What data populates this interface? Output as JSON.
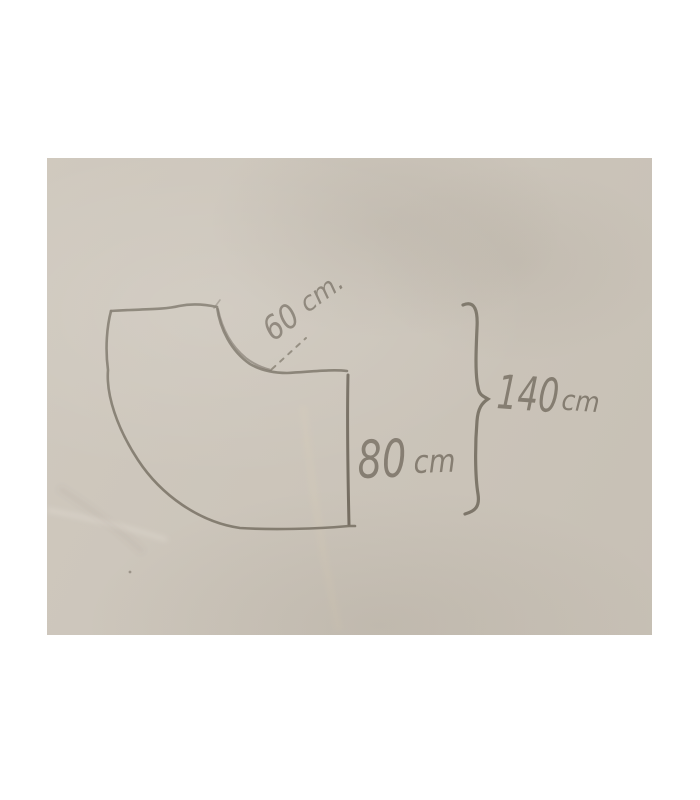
{
  "colors": {
    "page_bg": "#ffffff",
    "paper": "#cdc6bb",
    "pencil": "#7c7467",
    "pencil_dark": "#6f675b",
    "stain": "#d9ceb9"
  },
  "sketch": {
    "dimensions": {
      "curve": {
        "value": "60",
        "unit": "cm."
      },
      "side": {
        "value": "80",
        "unit": "cm"
      },
      "overall": {
        "value": "140",
        "unit": "cm"
      }
    }
  }
}
